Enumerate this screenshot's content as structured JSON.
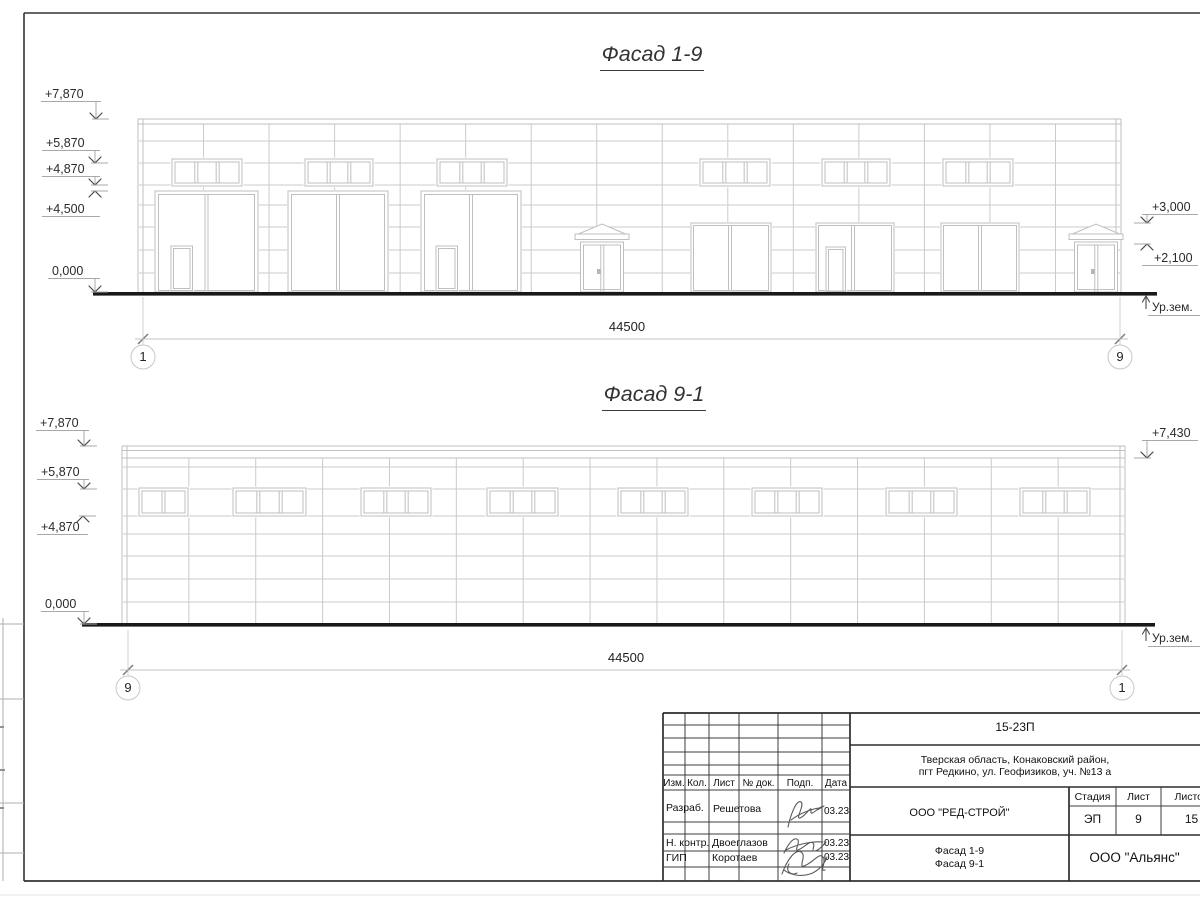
{
  "sheet_code_note": "architectural facade drawing sheet",
  "facades": [
    {
      "name": "facade-1-9",
      "title": "Фасад 1-9",
      "dim_label": "44500",
      "axis_left": "1",
      "axis_right": "9",
      "ground_label": "Ур.зем.",
      "elevation_marks": [
        {
          "label": "+7,870",
          "side": "left",
          "dir": "down",
          "level": 119,
          "ax": 96,
          "tx": 45,
          "ty": 88
        },
        {
          "label": "+5,870",
          "side": "left",
          "dir": "down",
          "level": 163,
          "ax": 95,
          "tx": 46,
          "ty": 137
        },
        {
          "label": "+4,870",
          "side": "left",
          "dir": "down",
          "level": 185,
          "ax": 95,
          "tx": 46,
          "ty": 163
        },
        {
          "label": "+4,500",
          "side": "left",
          "dir": "up",
          "level": 191,
          "ax": 95,
          "tx": 46,
          "ty": 203
        },
        {
          "label": "0,000",
          "side": "left",
          "dir": "down",
          "level": 292,
          "ax": 95,
          "tx": 52,
          "ty": 265
        },
        {
          "label": "+3,000",
          "side": "right",
          "dir": "down",
          "level": 223,
          "ax": 1147,
          "tx": 1152,
          "ty": 201
        },
        {
          "label": "+2,100",
          "side": "right",
          "dir": "up",
          "level": 244,
          "ax": 1147,
          "tx": 1154,
          "ty": 252
        }
      ],
      "ground_mark": {
        "x": 1146,
        "level": 296,
        "tx": 1152,
        "ty": 301
      },
      "geom": {
        "x1": 138,
        "x2": 1121,
        "top": 119,
        "ground": 293,
        "top_lines": [
          119,
          124
        ],
        "h_lines": [
          141,
          163,
          185,
          205,
          227,
          250,
          273
        ],
        "bays": 15,
        "ground_line": {
          "x1": 93,
          "x2": 1157
        },
        "win_y": [
          159,
          186
        ],
        "windows": [
          {
            "x": 172,
            "w": 70,
            "panes": 3
          },
          {
            "x": 305,
            "w": 68,
            "panes": 3
          },
          {
            "x": 437,
            "w": 70,
            "panes": 3
          },
          {
            "x": 700,
            "w": 70,
            "panes": 3
          },
          {
            "x": 822,
            "w": 68,
            "panes": 3
          },
          {
            "x": 943,
            "w": 70,
            "panes": 3
          }
        ],
        "door_y": [
          191,
          292
        ],
        "garage_doors": [
          {
            "x": 155,
            "w": 103,
            "door": 171
          },
          {
            "x": 288,
            "w": 100
          },
          {
            "x": 421,
            "w": 100,
            "door": 436
          }
        ],
        "opening_y": [
          223,
          292
        ],
        "openings": [
          {
            "x": 691,
            "w": 80,
            "mull": 730
          },
          {
            "x": 816,
            "w": 78,
            "door": 826,
            "mull": 853
          },
          {
            "x": 941,
            "w": 78,
            "mull": 980
          }
        ],
        "entry_doors": [
          {
            "cx": 602
          },
          {
            "cx": 1096
          }
        ],
        "dim": {
          "y": 339,
          "x1": 143,
          "x2": 1120,
          "ext_top": 297,
          "ext_bot": 345
        },
        "axis_y": 357
      }
    },
    {
      "name": "facade-9-1",
      "title": "Фасад 9-1",
      "dim_label": "44500",
      "axis_left": "9",
      "axis_right": "1",
      "ground_label": "Ур.зем.",
      "elevation_marks": [
        {
          "label": "+7,870",
          "side": "left",
          "dir": "down",
          "level": 446,
          "ax": 84,
          "tx": 40,
          "ty": 417
        },
        {
          "label": "+5,870",
          "side": "left",
          "dir": "down",
          "level": 489,
          "ax": 84,
          "tx": 41,
          "ty": 466
        },
        {
          "label": "+4,870",
          "side": "left",
          "dir": "up",
          "level": 516,
          "ax": 83,
          "tx": 41,
          "ty": 521
        },
        {
          "label": "0,000",
          "side": "left",
          "dir": "down",
          "level": 624,
          "ax": 84,
          "tx": 45,
          "ty": 598
        },
        {
          "label": "+7,430",
          "side": "right",
          "dir": "down",
          "level": 458,
          "ax": 1147,
          "tx": 1152,
          "ty": 427
        }
      ],
      "ground_mark": {
        "x": 1146,
        "level": 628,
        "tx": 1152,
        "ty": 632
      },
      "geom": {
        "x1": 122,
        "x2": 1125,
        "top": 446,
        "ground": 624,
        "top_lines": [
          446,
          450.5,
          458
        ],
        "h_lines": [
          467,
          489,
          516,
          534,
          556,
          579,
          602
        ],
        "bays": 15,
        "ground_line": {
          "x1": 82,
          "x2": 1155
        },
        "win_y": [
          488,
          516
        ],
        "windows": [
          {
            "x": 139,
            "w": 49,
            "panes": 2
          },
          {
            "x": 233,
            "w": 73,
            "panes": 3
          },
          {
            "x": 361,
            "w": 70,
            "panes": 3
          },
          {
            "x": 487,
            "w": 71,
            "panes": 3
          },
          {
            "x": 618,
            "w": 70,
            "panes": 3
          },
          {
            "x": 752,
            "w": 70,
            "panes": 3
          },
          {
            "x": 886,
            "w": 71,
            "panes": 3
          },
          {
            "x": 1020,
            "w": 70,
            "panes": 3
          }
        ],
        "door_y": [
          0,
          0
        ],
        "garage_doors": [],
        "opening_y": [
          0,
          0
        ],
        "openings": [],
        "entry_doors": [],
        "dim": {
          "y": 670,
          "x1": 128,
          "x2": 1122,
          "ext_top": 630,
          "ext_bot": 676
        },
        "axis_y": 688
      }
    }
  ],
  "titleblock": {
    "code": "15-23П",
    "address1": "Тверская область, Конаковский район,",
    "address2": "пгт Редкино, ул. Геофизиков, уч. №13 а",
    "rev_headers": [
      "Изм.",
      "Кол.",
      "Лист",
      "№ док.",
      "Подп.",
      "Дата"
    ],
    "sig_rows": [
      {
        "role": "Разраб.",
        "name": "Решетова",
        "date": "03.23"
      },
      {
        "role": "Н. контр.",
        "name": "Двоеглазов",
        "date": "03.23"
      },
      {
        "role": "ГИП",
        "name": "Коротаев",
        "date": "03.23"
      }
    ],
    "org": "ООО \"РЕД-СТРОЙ\"",
    "stage_header": "Стадия",
    "sheet_header": "Лист",
    "sheets_header": "Листов",
    "stage": "ЭП",
    "sheet_no": "9",
    "sheets_total": "15",
    "subject1": "Фасад 1-9",
    "subject2": "Фасад 9-1",
    "firm": "ООО \"Альянс\""
  }
}
